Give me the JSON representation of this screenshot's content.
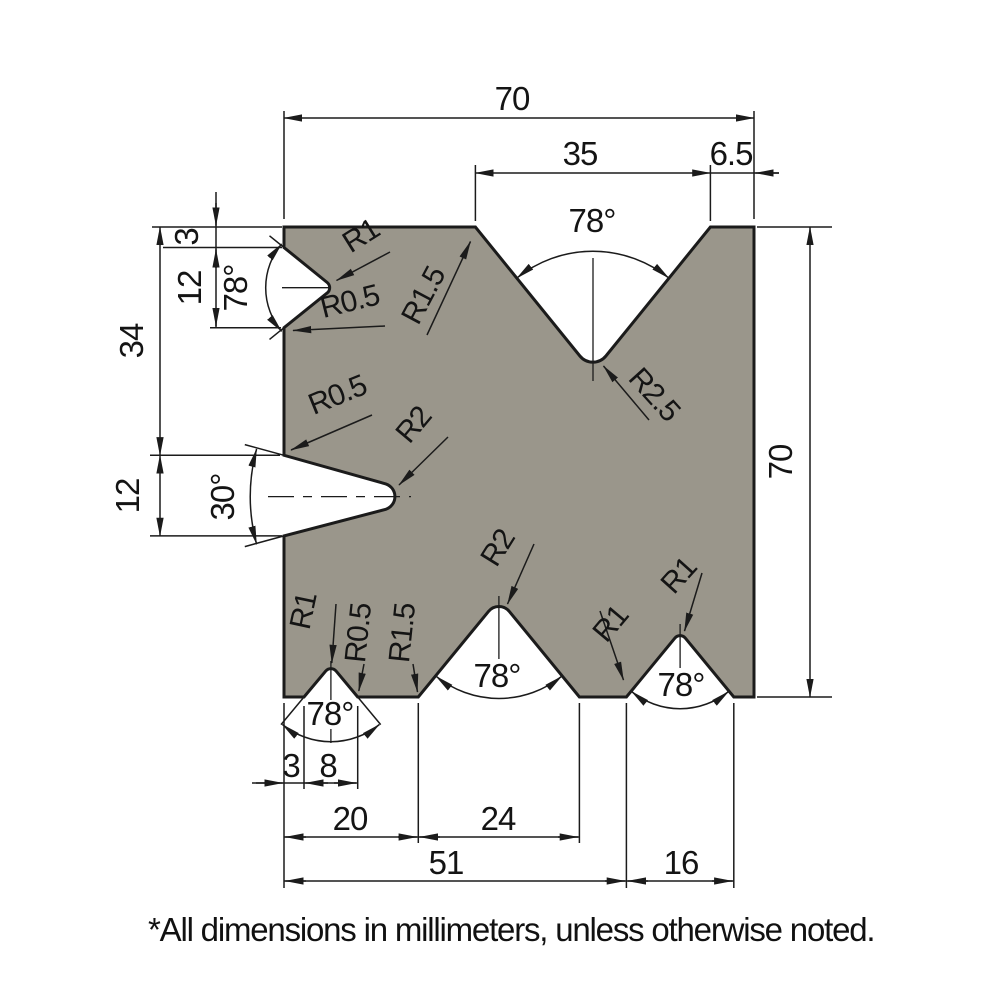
{
  "colors": {
    "die_fill": "#9a968b",
    "line": "#1b1b1b"
  },
  "dims": {
    "width_total": "70",
    "top_v_width": "35",
    "top_right_offset": "6.5",
    "left_top_offset": "3",
    "left_notch_height": "12",
    "left_mid_offset": "34",
    "left_lower_height": "12",
    "height_total": "70",
    "bottom_small_offset": "3",
    "bottom_small_width": "8",
    "bottom_mid_offset": "20",
    "bottom_mid_width": "24",
    "bottom_right_offset": "51",
    "bottom_right_width": "16"
  },
  "angles": {
    "left_notch": "78°",
    "top_v": "78°",
    "lower_left_notch": "30°",
    "bottom_small_v": "78°",
    "bottom_mid_v": "78°",
    "bottom_right_v": "78°"
  },
  "radii": {
    "left_notch_tip": "R1",
    "left_notch_corner": "R0.5",
    "top_v_shoulder": "R1.5",
    "top_v_tip": "R2.5",
    "lower_notch_corner": "R0.5",
    "lower_notch_tip": "R2",
    "bottom_small_tip": "R1",
    "bottom_small_corner": "R0.5",
    "bottom_mid_corner": "R1.5",
    "bottom_mid_tip": "R2",
    "bottom_right_corner": "R1",
    "bottom_right_tip": "R1"
  },
  "footnote": "*All dimensions in millimeters, unless otherwise noted."
}
